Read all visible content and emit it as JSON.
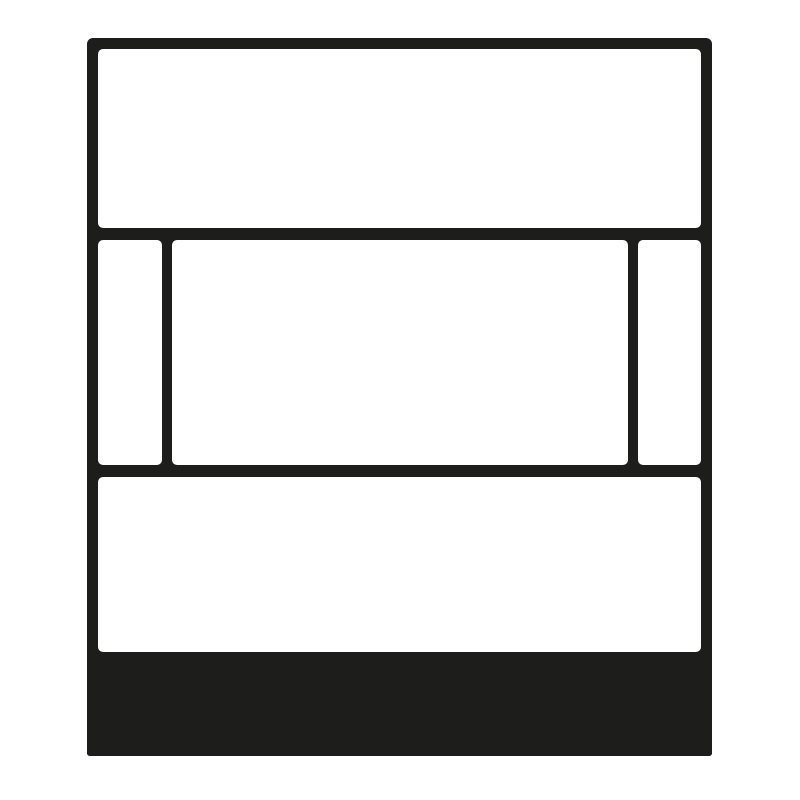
{
  "colors": {
    "ink": "#1d1d1b",
    "panel": "#ffffff",
    "background": "#ffffff"
  },
  "illustration": {
    "name": "rectangular-plate-line-art",
    "style": "monochrome line illustration",
    "parts": [
      {
        "name": "plate-frame"
      },
      {
        "name": "top-panel"
      },
      {
        "name": "left-side-panel"
      },
      {
        "name": "center-panel"
      },
      {
        "name": "right-side-panel"
      },
      {
        "name": "bottom-panel"
      },
      {
        "name": "base-black-band"
      }
    ]
  }
}
